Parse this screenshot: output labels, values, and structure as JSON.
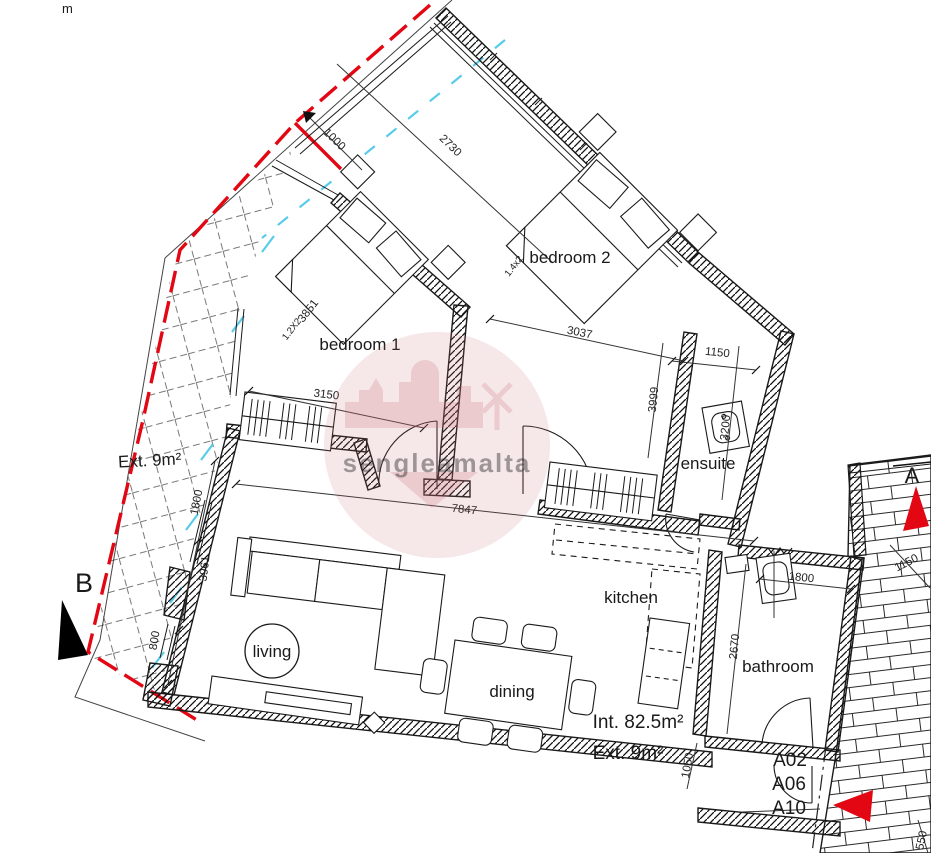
{
  "title": "apartment floor plan",
  "corner": {
    "cut_text": "m"
  },
  "rooms": {
    "bedroom1": "bedroom 1",
    "bedroom2": "bedroom 2",
    "ensuite": "ensuite",
    "kitchen": "kitchen",
    "bathroom": "bathroom",
    "living": "living",
    "dining": "dining"
  },
  "areas": {
    "terrace_ext": "Ext. 9m²",
    "internal_total": "Int. 82.5m²",
    "external_total": "Ext. 9m²"
  },
  "markers": {
    "section_b": "B",
    "section_a_partial": "A",
    "unit_1": "A02",
    "unit_2": "A06",
    "unit_3": "A10"
  },
  "watermark": {
    "text": "sengleamalta"
  },
  "dimensions": {
    "notch": "1000",
    "entry_wall": "2730",
    "bed1_diag": "3851",
    "bed1_size": "1.2X2",
    "bed2_size": "1.4x2",
    "bed2_width": "3037",
    "bed1_width": "3150",
    "bed2_depth": "3999",
    "ensuite_width": "1150",
    "ensuite_depth": "3200",
    "living_width": "7847",
    "terrace_1800": "1800",
    "terrace_3961": "3961",
    "terrace_800": "800",
    "bath_width": "1800",
    "bath_depth": "2670",
    "hall_1050": "1050",
    "stairs_1150": "1150",
    "stairs_550": "550"
  },
  "colors": {
    "boundary_red": "#e30613",
    "utility_cyan": "#45c6e8",
    "watermark_pink": "#c96b74",
    "wall_black": "#1a1a1a"
  }
}
